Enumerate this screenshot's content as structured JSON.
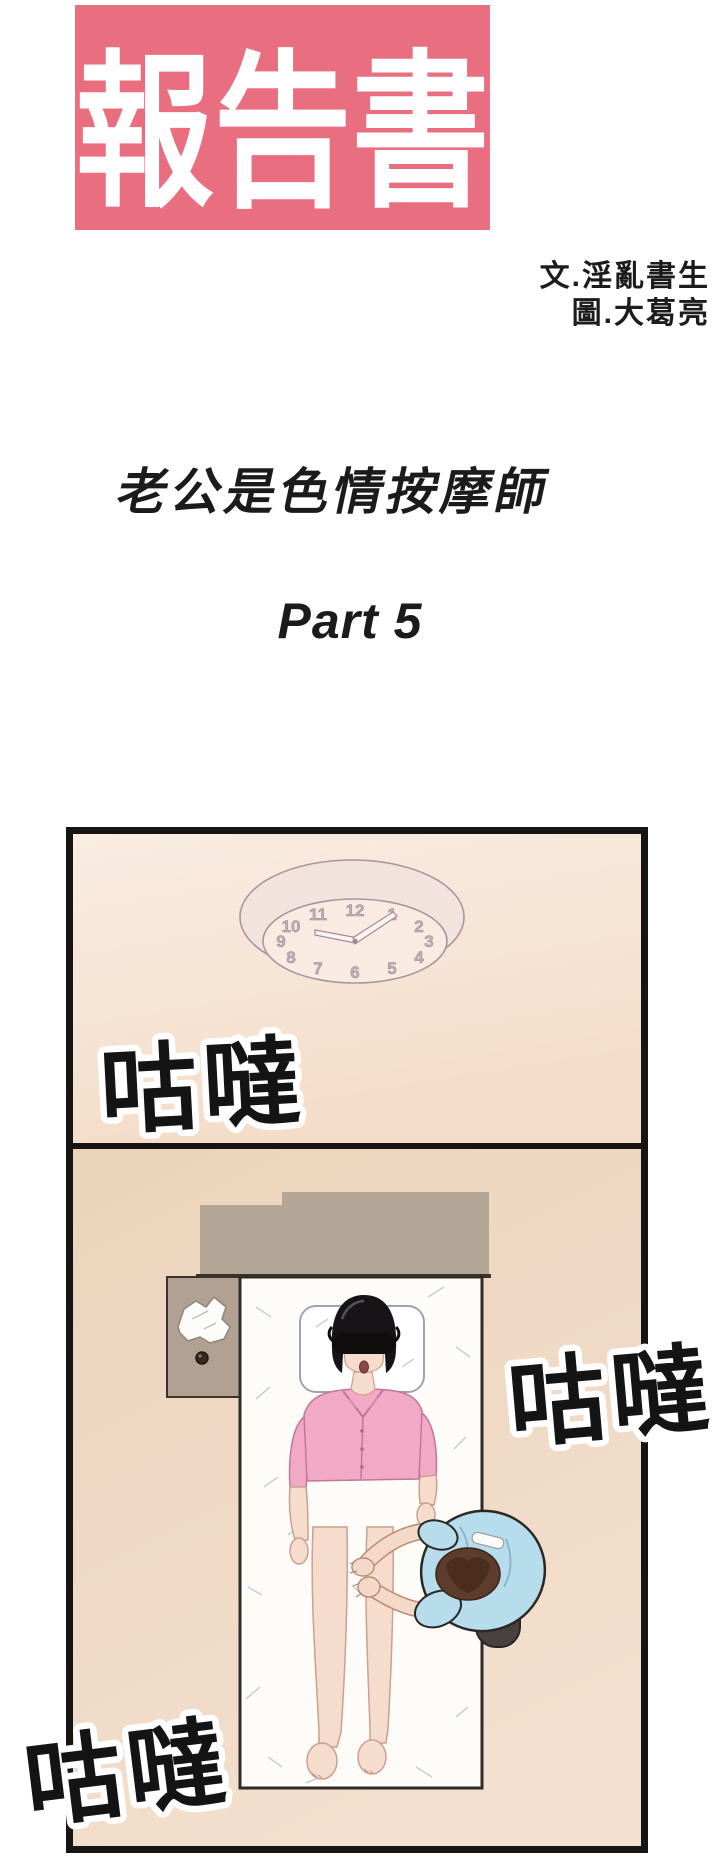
{
  "header": {
    "series_title": "報告書",
    "credit_writer": "文.淫亂書生",
    "credit_artist": "圖.大葛亮",
    "episode_title": "老公是色情按摩師",
    "part_label": "Part 5"
  },
  "panel": {
    "sfx": [
      {
        "text": "咕噠"
      },
      {
        "text": "咕噠"
      },
      {
        "text": "咕噠"
      }
    ],
    "clock_numerals": [
      "12",
      "1",
      "2",
      "3",
      "4",
      "5",
      "6",
      "7",
      "8",
      "9",
      "10",
      "11"
    ]
  },
  "colors": {
    "page_background": "#ffffff",
    "title_box": "#e96e7f",
    "title_text": "#ffffff",
    "panel_border": "#171513",
    "wall_upper": "#f8e9dc",
    "wall_lower": "#eed7c0",
    "headboard": "#b4a697",
    "mattress": "#fdfcf9",
    "shirt_pink": "#f1a9c5",
    "skirt_grey": "#6f6b71",
    "shirt_blue": "#b7dcec",
    "sfx_fill": "#141414",
    "sfx_outline": "#ffffff"
  }
}
